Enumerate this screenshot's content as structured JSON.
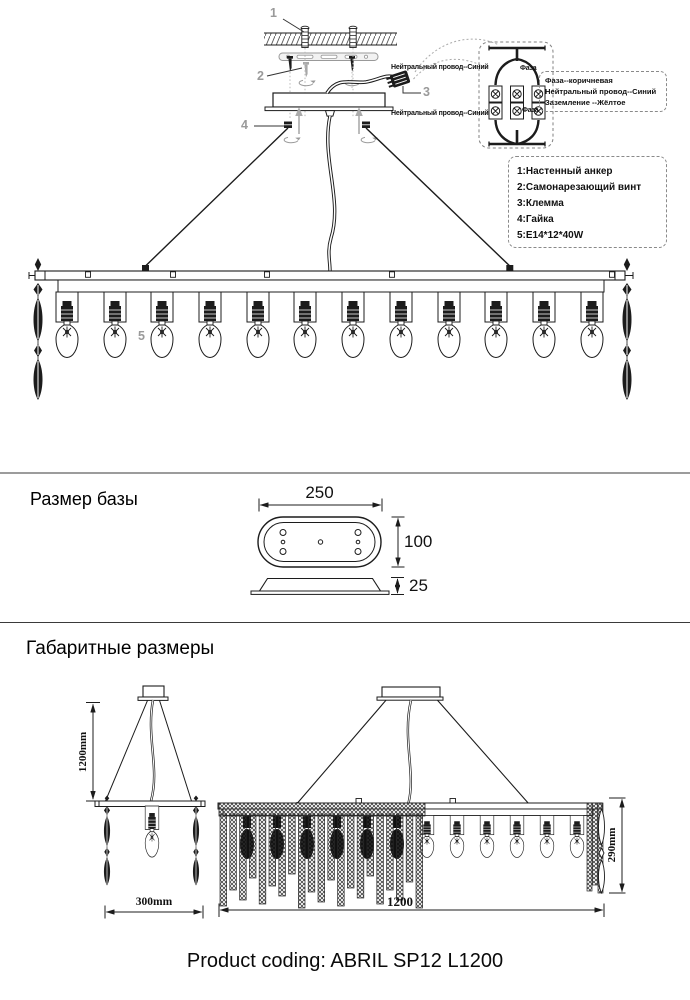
{
  "colors": {
    "ink": "#1c1c1c",
    "gray": "#9a9a9a"
  },
  "installation": {
    "callouts": {
      "c1": "1",
      "c2": "2",
      "c3": "3",
      "c4": "4",
      "c5": "5"
    },
    "wiring": {
      "neutral_top": "Нейтральный провод--Синий",
      "phase_top": "Фаза",
      "neutral_bottom": "Нейтральный провод--Синий",
      "phase_bottom": "Фаза"
    },
    "legend": {
      "line1": "Фаза--коричневая",
      "line2": "Нейтральный провод--Синий",
      "line3": "Заземление --Жёлтое"
    },
    "parts": {
      "p1": "1:Настенный анкер",
      "p2": "2:Самонарезающий винт",
      "p3": "3:Клемма",
      "p4": "4:Гайка",
      "p5": "5:E14*12*40W"
    }
  },
  "base_size": {
    "title": "Размер базы",
    "width": "250",
    "depth": "100",
    "height": "25"
  },
  "overall": {
    "title": "Габаритные размеры",
    "drop_height": "1200mm",
    "side_width": "300mm",
    "body_height": "290mm",
    "length": "1200"
  },
  "footer": {
    "product_coding": "Product coding: ABRIL SP12 L1200"
  }
}
